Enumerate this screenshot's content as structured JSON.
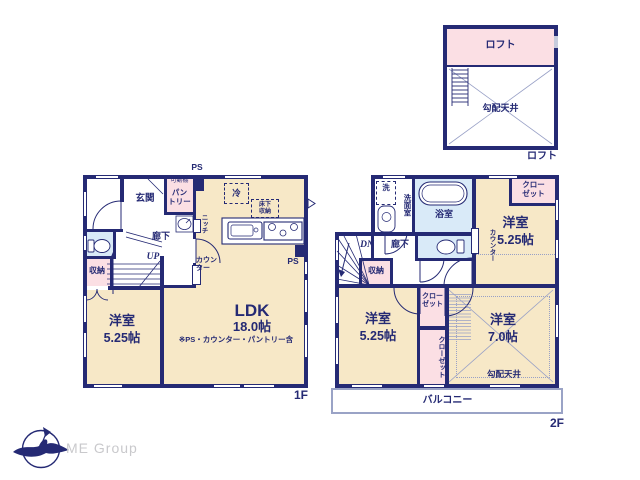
{
  "colors": {
    "wall": "#252a74",
    "room_fill": "#f7e8c7",
    "wet_fill": "#d9eaf8",
    "closet_fill": "#fbdfe4",
    "thin_line": "#98a0c6",
    "logo_text": "#c9c9cc"
  },
  "floor1": {
    "label": "1F",
    "entrance": "玄関",
    "movable_shelf": "可動棚",
    "pantry": "パン\nトリー",
    "ps_top": "PS",
    "ps_side": "PS",
    "fridge": "冷",
    "underfloor_storage": "床下\n収納",
    "niche": "ニッチ",
    "hallway": "廊下",
    "stairs_up": "UP",
    "counter": "カウン\nター",
    "storage": "収納",
    "bedroom": {
      "name": "洋室",
      "size": "5.25帖"
    },
    "ldk": {
      "name": "LDK",
      "size": "18.0帖",
      "note": "※PS・カウンター・パントリー含"
    }
  },
  "floor2": {
    "label": "2F",
    "washer": "洗",
    "washroom": "洗面室",
    "bathroom": "浴室",
    "stairs_down": "DN",
    "hallway": "廊下",
    "storage": "収納",
    "closet_a": "クロー\nゼット",
    "counter": "カウンター",
    "bedroom_a": {
      "name": "洋室",
      "size": "5.25帖"
    },
    "closet_b": "クロー\nゼット",
    "closet_c": "クローゼット",
    "bedroom_b": {
      "name": "洋室",
      "size": "5.25帖"
    },
    "bedroom_c": {
      "name": "洋室",
      "size": "7.0帖"
    },
    "sloped_ceiling": "勾配天井",
    "balcony": "バルコニー"
  },
  "loft": {
    "label": "ロフト",
    "caption": "ロフト",
    "sloped_ceiling": "勾配天井"
  },
  "logo": {
    "company": "ME Group"
  }
}
